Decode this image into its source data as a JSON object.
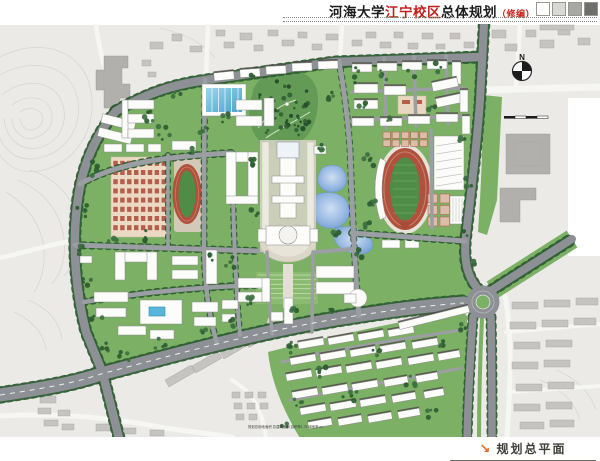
{
  "header": {
    "title_parts": {
      "university": "河海大学",
      "campus": "江宁校区",
      "suffix_main": "总体规划",
      "suffix_note": "（修编）"
    },
    "legend_squares": [
      "#ffffff",
      "#d8d8d5",
      "#a7a7a3",
      "#6e6e6a"
    ]
  },
  "map": {
    "north_label": "N",
    "stats_note": "规划总用地面积 总建筑面积 容积率1.75 绿地率 m²",
    "features": [
      "topographic-contours",
      "campus-green",
      "central-lake",
      "park-hill",
      "main-stadium",
      "small-running-track",
      "dormitory-grid",
      "central-axis-library-plaza",
      "roundabout",
      "south-dormitory-area"
    ],
    "colors": {
      "campus_green": "#7cb065",
      "road_gray": "#8d9095",
      "track_red": "#b0513e",
      "lake_blue": "#7fa6d6",
      "context_gray": "#ebeae7",
      "building_white": "#fcfcfa",
      "title_red": "#c4201c"
    }
  },
  "footer": {
    "arrow_icon": "↘",
    "label": "规划总平面",
    "accent": "#e2661a"
  }
}
